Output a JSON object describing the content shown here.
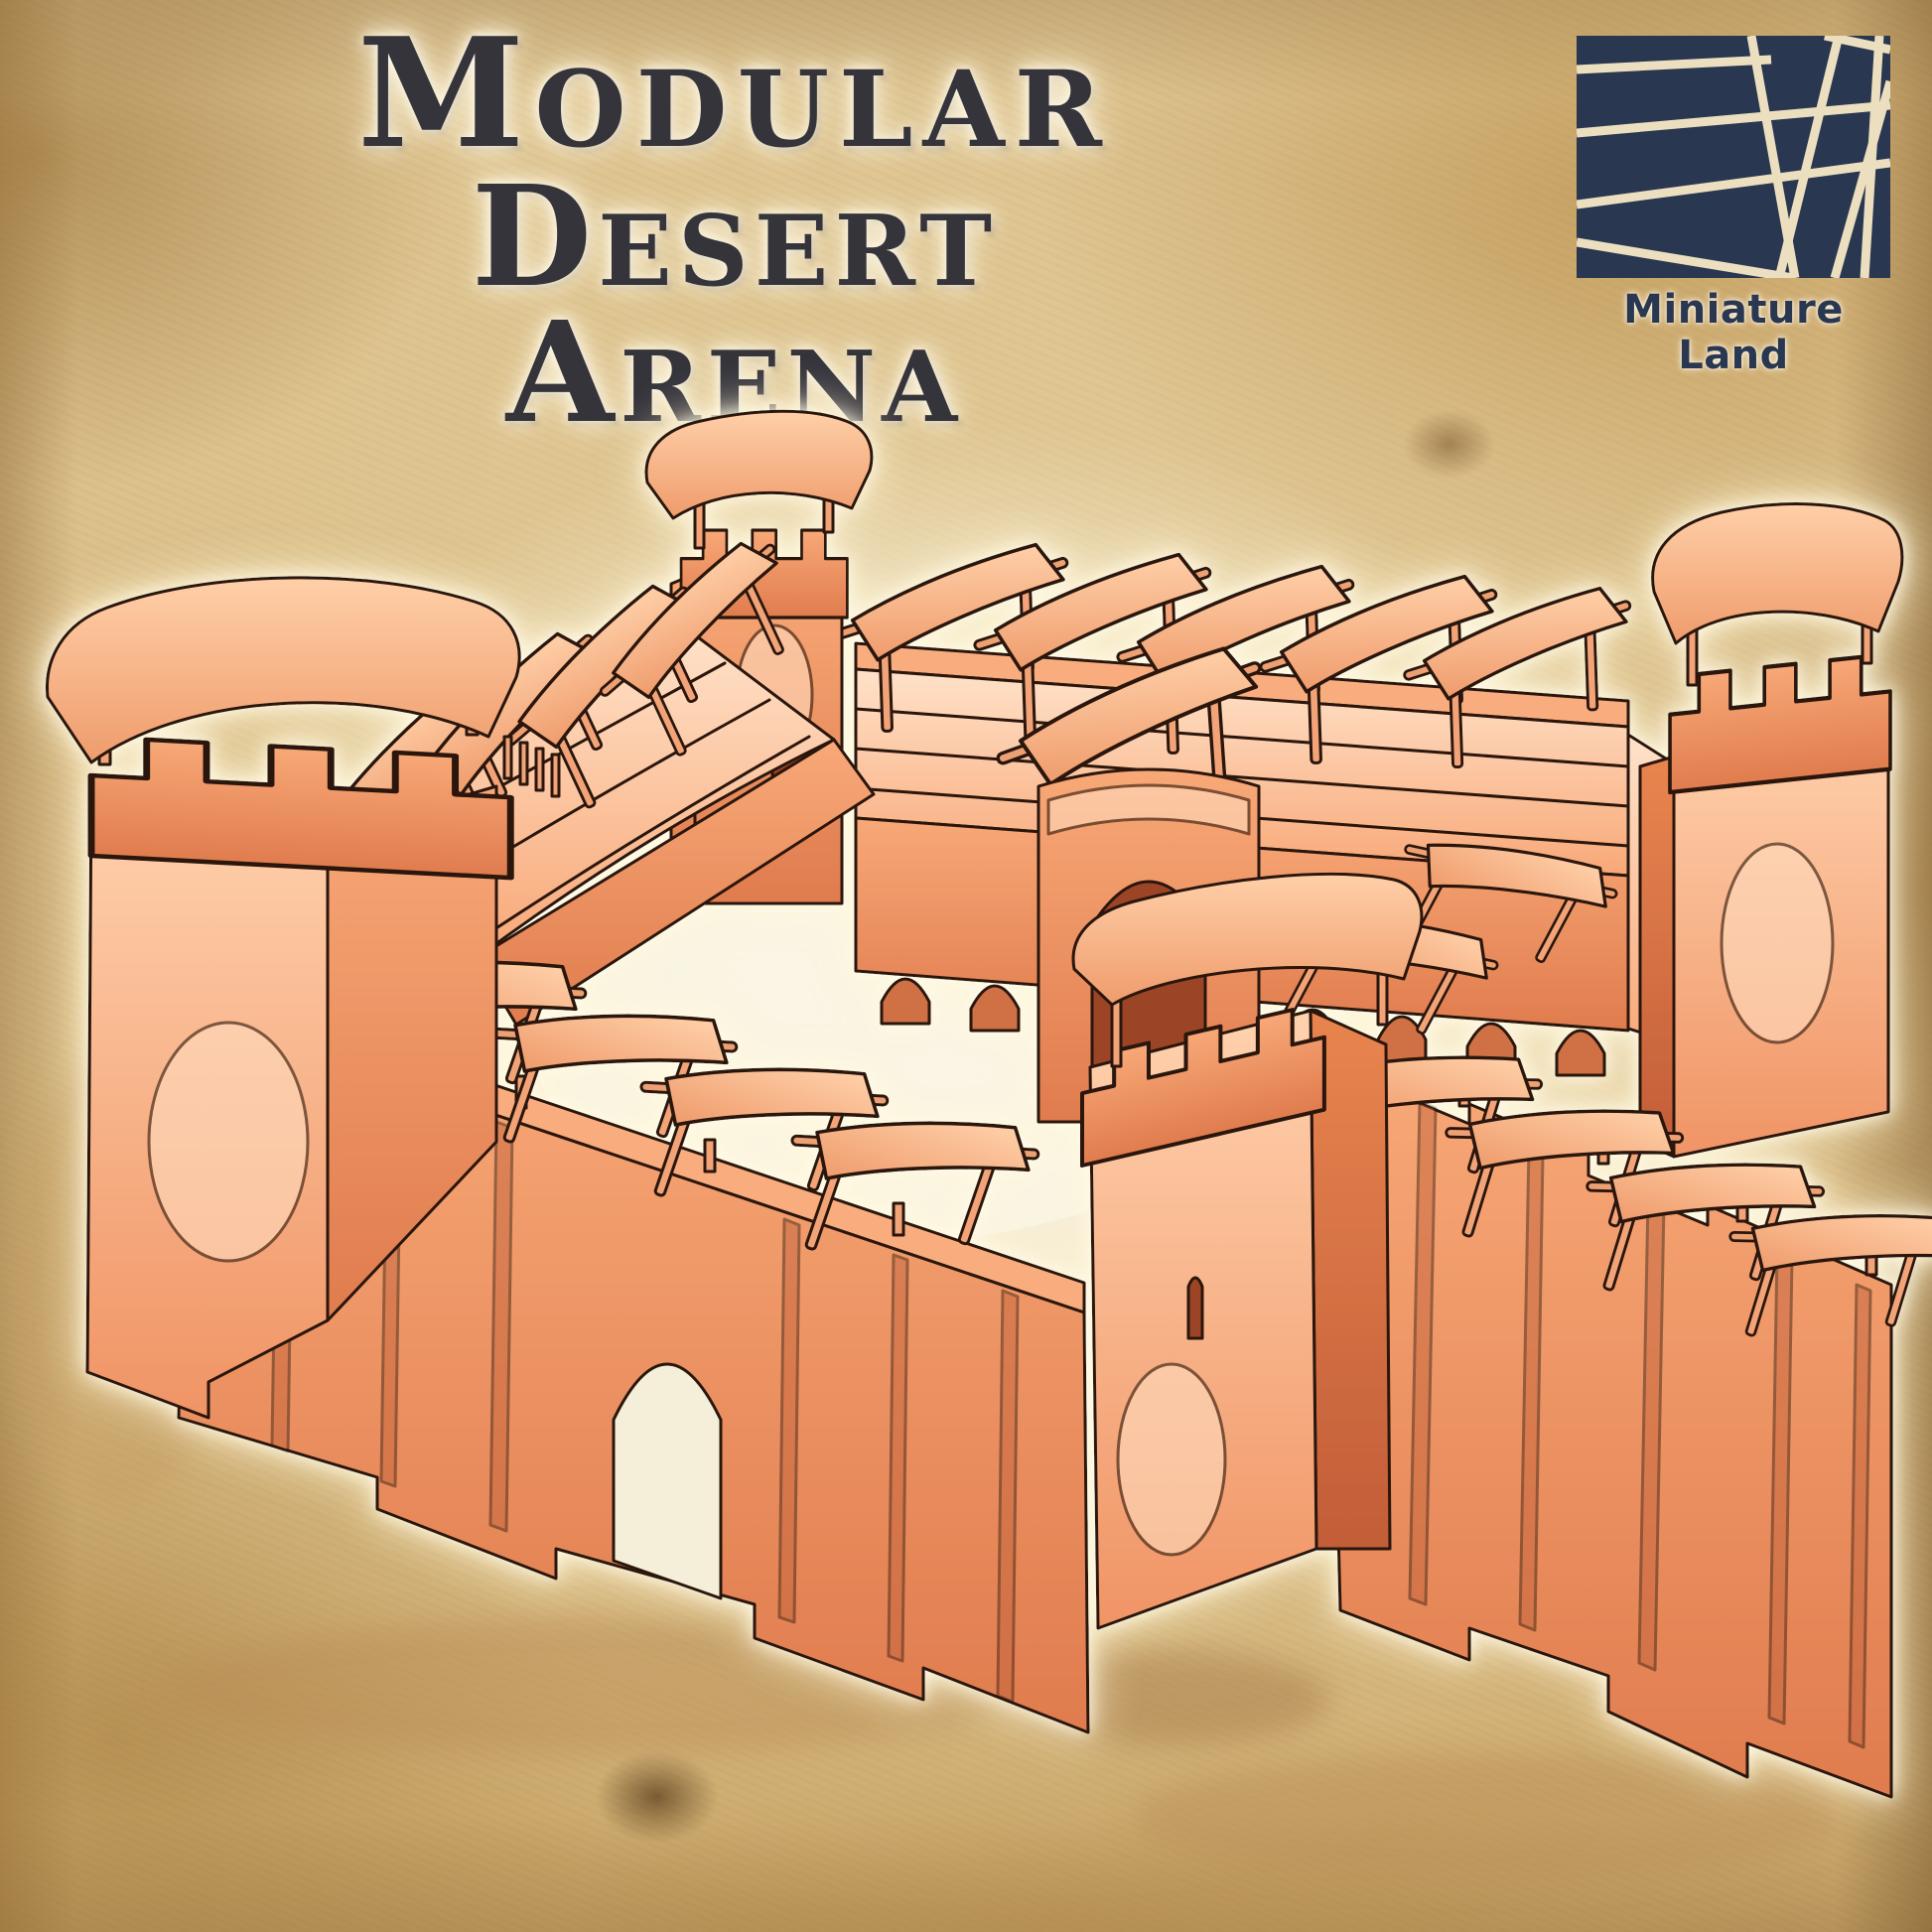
{
  "header": {
    "title_line1": "Modular",
    "title_line2": "Desert Arena"
  },
  "brand": {
    "name": "Miniature Land"
  },
  "illustration": {
    "subject": "terracotta modular desert arena miniature"
  },
  "colors": {
    "terracotta_mid": "#f09465",
    "terracotta_highlight": "#ffd2ae",
    "terracotta_shadow": "#c25d38",
    "parchment_light": "#f8f1dc",
    "parchment_dark": "#b98a50",
    "logo_navy": "#2a3750",
    "title_ink": "#35343b"
  }
}
